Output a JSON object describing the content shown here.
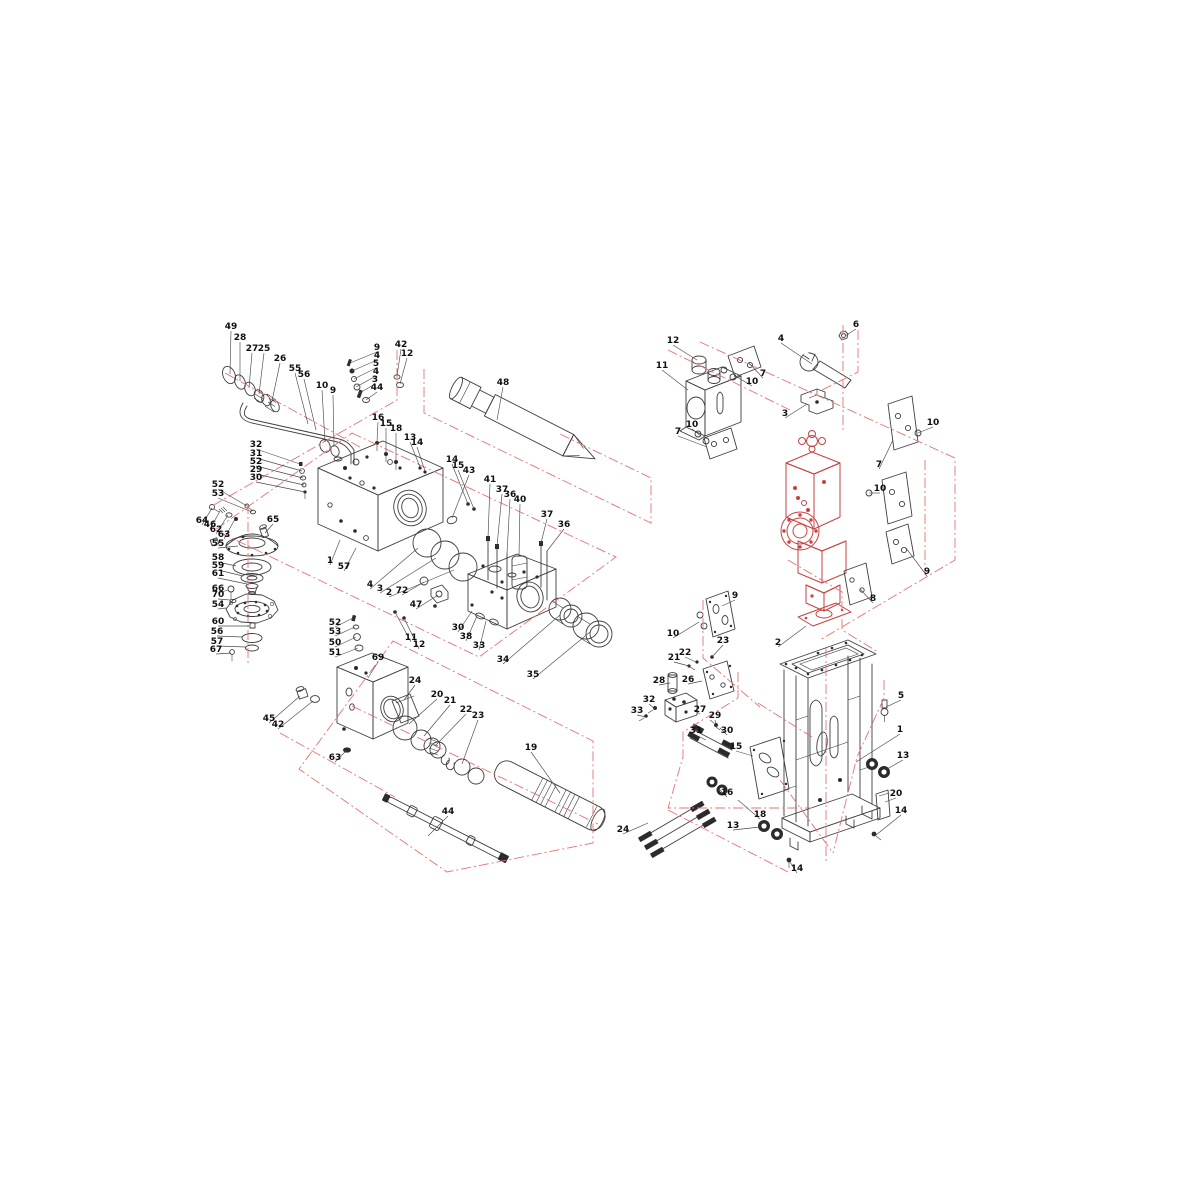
{
  "colors": {
    "part_line": "#3d3d3d",
    "red_part": "#c84040",
    "red_boundary": "#e57373",
    "leader": "#4a4a4a",
    "label_text": "#101010",
    "background": "#ffffff"
  },
  "labels": [
    {
      "t": "49",
      "x": 231,
      "y": 329,
      "tx": 230,
      "ty": 374
    },
    {
      "t": "28",
      "x": 240,
      "y": 340,
      "tx": 240,
      "ty": 381
    },
    {
      "t": "27",
      "x": 252,
      "y": 351,
      "tx": 249,
      "ty": 388
    },
    {
      "t": "25",
      "x": 264,
      "y": 351,
      "tx": 259,
      "ty": 394
    },
    {
      "t": "26",
      "x": 280,
      "y": 361,
      "tx": 272,
      "ty": 401
    },
    {
      "t": "55",
      "x": 295,
      "y": 371,
      "tx": 308,
      "ty": 424
    },
    {
      "t": "56",
      "x": 304,
      "y": 377,
      "tx": 316,
      "ty": 430
    },
    {
      "t": "10",
      "x": 322,
      "y": 388,
      "tx": 325,
      "ty": 442
    },
    {
      "t": "9",
      "x": 333,
      "y": 393,
      "tx": 334,
      "ty": 447
    },
    {
      "t": "9",
      "x": 377,
      "y": 350,
      "tx": 350,
      "ty": 363
    },
    {
      "t": "4",
      "x": 377,
      "y": 358,
      "tx": 352,
      "ty": 371
    },
    {
      "t": "5",
      "x": 376,
      "y": 366,
      "tx": 354,
      "ty": 379
    },
    {
      "t": "4",
      "x": 376,
      "y": 374,
      "tx": 356,
      "ty": 387
    },
    {
      "t": "3",
      "x": 375,
      "y": 382,
      "tx": 358,
      "ty": 394
    },
    {
      "t": "44",
      "x": 377,
      "y": 390,
      "tx": 366,
      "ty": 400
    },
    {
      "t": "42",
      "x": 401,
      "y": 347,
      "tx": 397,
      "ty": 376
    },
    {
      "t": "12",
      "x": 407,
      "y": 356,
      "tx": 400,
      "ty": 384
    },
    {
      "t": "16",
      "x": 378,
      "y": 420,
      "tx": 377,
      "ty": 442
    },
    {
      "t": "15",
      "x": 386,
      "y": 426,
      "tx": 386,
      "ty": 453
    },
    {
      "t": "18",
      "x": 396,
      "y": 431,
      "tx": 396,
      "ty": 461
    },
    {
      "t": "13",
      "x": 410,
      "y": 440,
      "tx": 420,
      "ty": 467
    },
    {
      "t": "14",
      "x": 417,
      "y": 445,
      "tx": 425,
      "ty": 471
    },
    {
      "t": "14",
      "x": 452,
      "y": 462,
      "tx": 468,
      "ty": 504
    },
    {
      "t": "15",
      "x": 458,
      "y": 468,
      "tx": 474,
      "ty": 509
    },
    {
      "t": "48",
      "x": 503,
      "y": 385,
      "tx": 497,
      "ty": 420
    },
    {
      "t": "43",
      "x": 469,
      "y": 473,
      "tx": 452,
      "ty": 518
    },
    {
      "t": "41",
      "x": 490,
      "y": 482,
      "tx": 488,
      "ty": 538
    },
    {
      "t": "37",
      "x": 502,
      "y": 492,
      "tx": 497,
      "ty": 546
    },
    {
      "t": "36",
      "x": 510,
      "y": 497,
      "tx": 507,
      "ty": 554
    },
    {
      "t": "40",
      "x": 520,
      "y": 502,
      "tx": 519,
      "ty": 556
    },
    {
      "t": "37",
      "x": 547,
      "y": 517,
      "tx": 541,
      "ty": 543
    },
    {
      "t": "36",
      "x": 564,
      "y": 527,
      "tx": 547,
      "ty": 551
    },
    {
      "t": "32",
      "x": 256,
      "y": 447,
      "tx": 300,
      "ty": 464
    },
    {
      "t": "31",
      "x": 256,
      "y": 456,
      "tx": 302,
      "ty": 471
    },
    {
      "t": "52",
      "x": 256,
      "y": 464,
      "tx": 303,
      "ty": 478
    },
    {
      "t": "29",
      "x": 256,
      "y": 472,
      "tx": 304,
      "ty": 485
    },
    {
      "t": "30",
      "x": 256,
      "y": 480,
      "tx": 305,
      "ty": 492
    },
    {
      "t": "52",
      "x": 218,
      "y": 487,
      "tx": 247,
      "ty": 506
    },
    {
      "t": "53",
      "x": 218,
      "y": 496,
      "tx": 252,
      "ty": 512
    },
    {
      "t": "64",
      "x": 202,
      "y": 523,
      "tx": 212,
      "ty": 508
    },
    {
      "t": "46",
      "x": 210,
      "y": 527,
      "tx": 220,
      "ty": 511
    },
    {
      "t": "62",
      "x": 216,
      "y": 532,
      "tx": 228,
      "ty": 515
    },
    {
      "t": "63",
      "x": 224,
      "y": 537,
      "tx": 235,
      "ty": 519
    },
    {
      "t": "65",
      "x": 273,
      "y": 522,
      "tx": 265,
      "ty": 533
    },
    {
      "t": "55",
      "x": 218,
      "y": 546,
      "tx": 238,
      "ty": 546
    },
    {
      "t": "58",
      "x": 218,
      "y": 560,
      "tx": 236,
      "ty": 566
    },
    {
      "t": "59",
      "x": 218,
      "y": 568,
      "tx": 243,
      "ty": 576
    },
    {
      "t": "61",
      "x": 218,
      "y": 576,
      "tx": 247,
      "ty": 584
    },
    {
      "t": "66",
      "x": 218,
      "y": 591,
      "tx": 228,
      "ty": 590
    },
    {
      "t": "70",
      "x": 218,
      "y": 597,
      "tx": 230,
      "ty": 600
    },
    {
      "t": "54",
      "x": 218,
      "y": 607,
      "tx": 226,
      "ty": 608
    },
    {
      "t": "60",
      "x": 218,
      "y": 624,
      "tx": 249,
      "ty": 626
    },
    {
      "t": "56",
      "x": 217,
      "y": 634,
      "tx": 242,
      "ty": 637
    },
    {
      "t": "57",
      "x": 217,
      "y": 644,
      "tx": 246,
      "ty": 647
    },
    {
      "t": "67",
      "x": 216,
      "y": 652,
      "tx": 231,
      "ty": 653
    },
    {
      "t": "1",
      "x": 330,
      "y": 563,
      "tx": 340,
      "ty": 540
    },
    {
      "t": "57",
      "x": 344,
      "y": 569,
      "tx": 356,
      "ty": 548
    },
    {
      "t": "4",
      "x": 370,
      "y": 587,
      "tx": 418,
      "ty": 548
    },
    {
      "t": "3",
      "x": 380,
      "y": 591,
      "tx": 436,
      "ty": 558
    },
    {
      "t": "2",
      "x": 389,
      "y": 595,
      "tx": 454,
      "ty": 570
    },
    {
      "t": "72",
      "x": 402,
      "y": 593,
      "tx": 424,
      "ty": 582
    },
    {
      "t": "47",
      "x": 416,
      "y": 607,
      "tx": 438,
      "ty": 595
    },
    {
      "t": "11",
      "x": 411,
      "y": 640,
      "tx": 395,
      "ty": 612
    },
    {
      "t": "12",
      "x": 419,
      "y": 647,
      "tx": 404,
      "ty": 618
    },
    {
      "t": "30",
      "x": 458,
      "y": 630,
      "tx": 472,
      "ty": 611
    },
    {
      "t": "38",
      "x": 466,
      "y": 639,
      "tx": 477,
      "ty": 616
    },
    {
      "t": "33",
      "x": 479,
      "y": 648,
      "tx": 486,
      "ty": 621
    },
    {
      "t": "34",
      "x": 503,
      "y": 662,
      "tx": 560,
      "ty": 615
    },
    {
      "t": "35",
      "x": 533,
      "y": 677,
      "tx": 590,
      "ty": 632
    },
    {
      "t": "52",
      "x": 335,
      "y": 625,
      "tx": 353,
      "ty": 618
    },
    {
      "t": "53",
      "x": 335,
      "y": 634,
      "tx": 355,
      "ty": 627
    },
    {
      "t": "50",
      "x": 335,
      "y": 645,
      "tx": 356,
      "ty": 637
    },
    {
      "t": "51",
      "x": 335,
      "y": 655,
      "tx": 358,
      "ty": 648
    },
    {
      "t": "69",
      "x": 378,
      "y": 660,
      "tx": 368,
      "ty": 678
    },
    {
      "t": "45",
      "x": 269,
      "y": 721,
      "tx": 300,
      "ty": 696
    },
    {
      "t": "42",
      "x": 278,
      "y": 727,
      "tx": 313,
      "ty": 701
    },
    {
      "t": "63",
      "x": 335,
      "y": 760,
      "tx": 346,
      "ty": 751
    },
    {
      "t": "24",
      "x": 415,
      "y": 683,
      "tx": 404,
      "ty": 700
    },
    {
      "t": "20",
      "x": 437,
      "y": 697,
      "tx": 409,
      "ty": 724
    },
    {
      "t": "21",
      "x": 450,
      "y": 703,
      "tx": 424,
      "ty": 736
    },
    {
      "t": "22",
      "x": 466,
      "y": 712,
      "tx": 435,
      "ty": 746
    },
    {
      "t": "23",
      "x": 478,
      "y": 718,
      "tx": 462,
      "ty": 764
    },
    {
      "t": "19",
      "x": 531,
      "y": 750,
      "tx": 560,
      "ty": 793
    },
    {
      "t": "44",
      "x": 448,
      "y": 814,
      "tx": 428,
      "ty": 836
    },
    {
      "t": "12",
      "x": 673,
      "y": 343,
      "tx": 697,
      "ty": 360
    },
    {
      "t": "11",
      "x": 662,
      "y": 368,
      "tx": 688,
      "ty": 390
    },
    {
      "t": "7",
      "x": 763,
      "y": 376,
      "tx": 749,
      "ty": 363
    },
    {
      "t": "10",
      "x": 752,
      "y": 384,
      "tx": 737,
      "ty": 377
    },
    {
      "t": "10",
      "x": 692,
      "y": 427,
      "tx": 701,
      "ty": 436
    },
    {
      "t": "7",
      "x": 678,
      "y": 434,
      "tx": 707,
      "ty": 447
    },
    {
      "t": "6",
      "x": 856,
      "y": 327,
      "tx": 845,
      "ty": 336
    },
    {
      "t": "4",
      "x": 781,
      "y": 341,
      "tx": 812,
      "ty": 364
    },
    {
      "t": "3",
      "x": 785,
      "y": 416,
      "tx": 807,
      "ty": 404
    },
    {
      "t": "10",
      "x": 933,
      "y": 425,
      "tx": 918,
      "ty": 433
    },
    {
      "t": "7",
      "x": 879,
      "y": 467,
      "tx": 893,
      "ty": 440
    },
    {
      "t": "10",
      "x": 880,
      "y": 491,
      "tx": 869,
      "ty": 493
    },
    {
      "t": "9",
      "x": 927,
      "y": 574,
      "tx": 906,
      "ty": 548
    },
    {
      "t": "8",
      "x": 873,
      "y": 601,
      "tx": 860,
      "ty": 589
    },
    {
      "t": "9",
      "x": 735,
      "y": 598,
      "tx": 722,
      "ty": 606
    },
    {
      "t": "10",
      "x": 673,
      "y": 636,
      "tx": 699,
      "ty": 622
    },
    {
      "t": "23",
      "x": 723,
      "y": 643,
      "tx": 712,
      "ty": 657
    },
    {
      "t": "22",
      "x": 685,
      "y": 655,
      "tx": 696,
      "ty": 662
    },
    {
      "t": "21",
      "x": 674,
      "y": 660,
      "tx": 689,
      "ty": 666
    },
    {
      "t": "2",
      "x": 778,
      "y": 645,
      "tx": 806,
      "ty": 626
    },
    {
      "t": "28",
      "x": 659,
      "y": 683,
      "tx": 670,
      "ty": 683
    },
    {
      "t": "26",
      "x": 688,
      "y": 682,
      "tx": 702,
      "ty": 681
    },
    {
      "t": "32",
      "x": 649,
      "y": 702,
      "tx": 655,
      "ty": 709
    },
    {
      "t": "33",
      "x": 637,
      "y": 713,
      "tx": 646,
      "ty": 717
    },
    {
      "t": "27",
      "x": 700,
      "y": 712,
      "tx": 694,
      "ty": 710
    },
    {
      "t": "29",
      "x": 715,
      "y": 718,
      "tx": 716,
      "ty": 725
    },
    {
      "t": "30",
      "x": 727,
      "y": 733,
      "tx": 720,
      "ty": 728
    },
    {
      "t": "31",
      "x": 696,
      "y": 733,
      "tx": 706,
      "ty": 740
    },
    {
      "t": "15",
      "x": 736,
      "y": 749,
      "tx": 753,
      "ty": 756
    },
    {
      "t": "16",
      "x": 727,
      "y": 795,
      "tx": 719,
      "ty": 789
    },
    {
      "t": "18",
      "x": 760,
      "y": 817,
      "tx": 738,
      "ty": 800
    },
    {
      "t": "13",
      "x": 733,
      "y": 828,
      "tx": 760,
      "ty": 827
    },
    {
      "t": "24",
      "x": 623,
      "y": 832,
      "tx": 648,
      "ty": 823
    },
    {
      "t": "5",
      "x": 901,
      "y": 698,
      "tx": 886,
      "ty": 707
    },
    {
      "t": "1",
      "x": 900,
      "y": 732,
      "tx": 856,
      "ty": 762
    },
    {
      "t": "13",
      "x": 903,
      "y": 758,
      "tx": 887,
      "ty": 769
    },
    {
      "t": "20",
      "x": 896,
      "y": 796,
      "tx": 885,
      "ty": 802
    },
    {
      "t": "14",
      "x": 901,
      "y": 813,
      "tx": 876,
      "ty": 835
    },
    {
      "t": "14",
      "x": 797,
      "y": 871,
      "tx": 790,
      "ty": 862
    }
  ],
  "red_paths": [
    "M397,350 L397,400 L212,506",
    "M424,369 L424,413 L651,523 L651,478 L560,434",
    "M352,433 L616,557 L479,657 L215,530 Z",
    "M225,373 L360,447",
    "M248,504 L248,666",
    "M393,641 L593,741 L593,843 L447,872 L299,769 Z",
    "M352,706 L598,824",
    "M280,733 L395,797",
    "M668,350 L790,410",
    "M858,330 L858,372 L822,390",
    "M700,342 L955,458 L955,560 L820,640",
    "M843,325 L843,430",
    "M925,460 L925,575",
    "M703,600 L703,658 L760,707",
    "M788,560 L842,592 L842,630 L878,652",
    "M738,672 L738,698 L683,732 L683,757 L668,808 L812,808",
    "M758,703 L812,737",
    "M884,680 L884,698 L857,757 L833,853",
    "M780,780 L833,853",
    "M668,810 L788,872",
    "M826,648 L826,862"
  ]
}
